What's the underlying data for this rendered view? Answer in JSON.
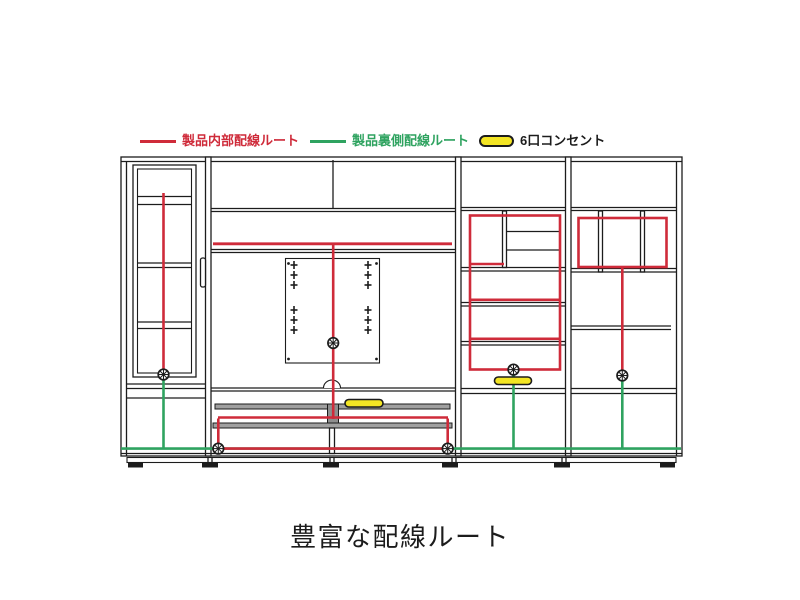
{
  "legend": {
    "internal": {
      "label": "製品内部配線ルート"
    },
    "backside": {
      "label": "製品裏側配線ルート"
    },
    "outlet": {
      "label": "6口コンセント"
    }
  },
  "caption": "豊富な配線ルート",
  "colors": {
    "internal-route": "#cf2b3a",
    "backside-route": "#2fa360",
    "outlet-fill": "#f3e524",
    "line": "#1c1c1c",
    "background": "#ffffff"
  }
}
